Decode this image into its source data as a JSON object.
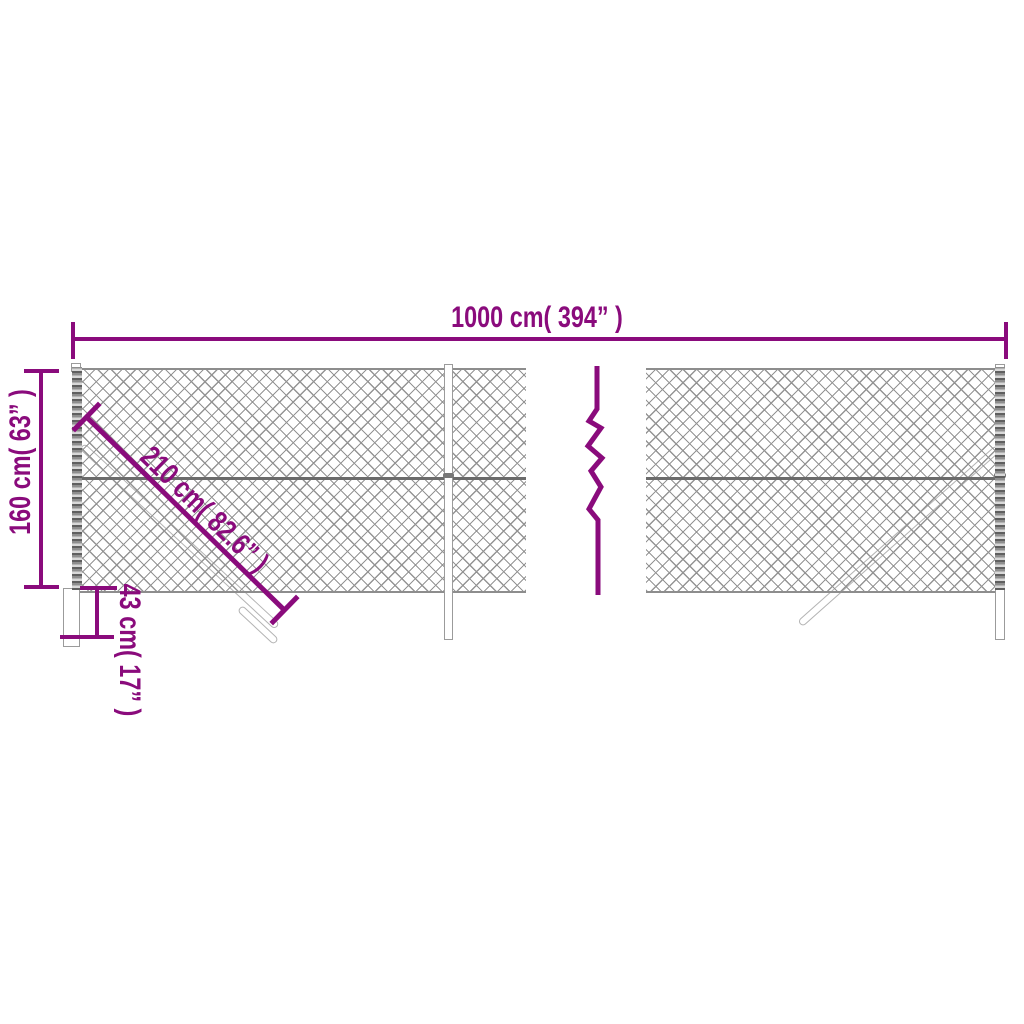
{
  "colors": {
    "accent": "#8a0b7c",
    "mesh_line": "#949494",
    "rail": "#6b6b6b",
    "post_border": "#9b9b9b",
    "background": "#ffffff"
  },
  "dimensions": {
    "width_label": "1000 cm( 394” )",
    "height_label": "160 cm( 63” )",
    "brace_label": "210 cm( 82.6” )",
    "depth_label": "43 cm( 17” )"
  },
  "symbols": {
    "break": "zigzag-break"
  }
}
